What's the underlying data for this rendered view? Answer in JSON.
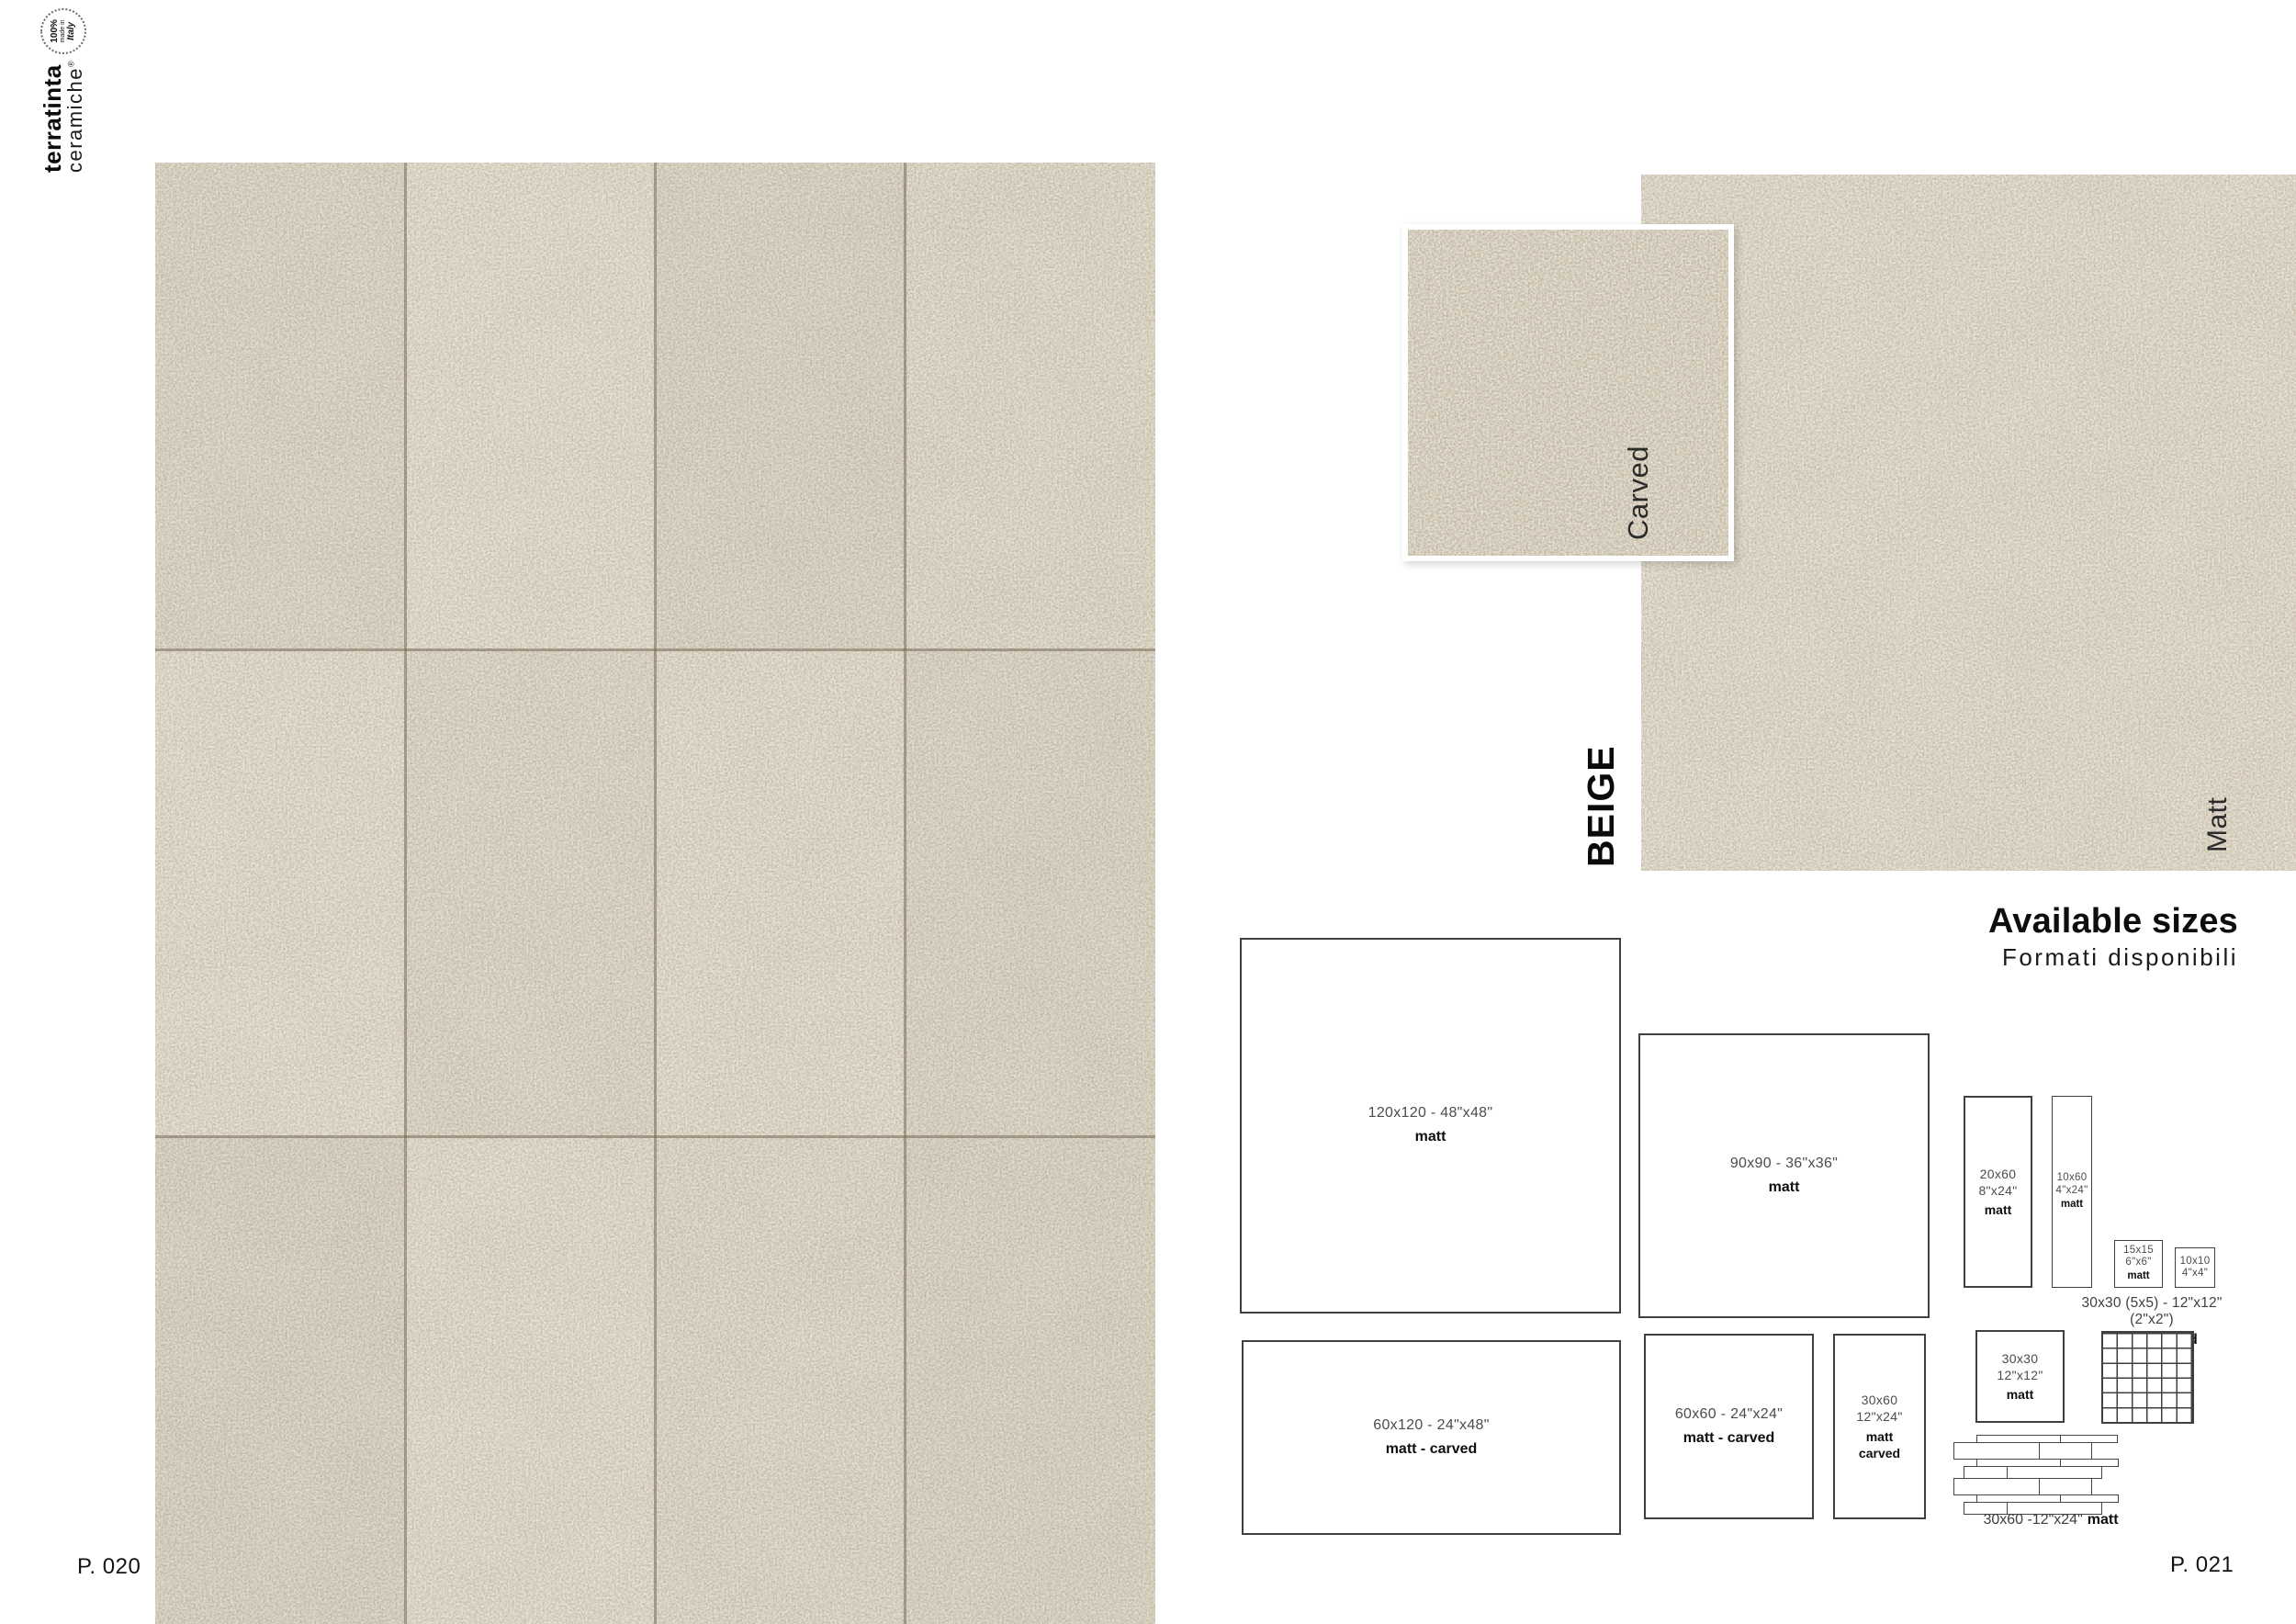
{
  "brand": {
    "name_bold": "terratinta",
    "name_light": "ceramiche",
    "reg": "®",
    "badge_percent": "100%",
    "badge_made": "made in",
    "badge_country": "Italy"
  },
  "pages": {
    "left": "P. 020",
    "right": "P. 021"
  },
  "product": {
    "collection": "BEIGE",
    "finishes": {
      "carved": "Carved",
      "matt": "Matt"
    }
  },
  "available_sizes": {
    "title": "Available sizes",
    "subtitle": "Formati disponibili",
    "boxes": {
      "s120x120": {
        "label": "120x120 - 48\"x48\"",
        "finish": "matt"
      },
      "s90x90": {
        "label": "90x90 - 36\"x36\"",
        "finish": "matt"
      },
      "s20x60": {
        "lines": [
          "20x60",
          "8\"x24\""
        ],
        "finish": "matt"
      },
      "s10x60": {
        "lines": [
          "10x60",
          "4\"x24\""
        ],
        "finish": "matt"
      },
      "s15x15": {
        "lines": [
          "15x15",
          "6\"x6\""
        ],
        "finish": "matt"
      },
      "s10x10": {
        "lines": [
          "10x10",
          "4\"x4\""
        ]
      },
      "s30x30": {
        "lines": [
          "30x30",
          "12\"x12\""
        ],
        "finish": "matt"
      },
      "s60x120": {
        "label": "60x120 - 24\"x48\"",
        "finish": "matt - carved"
      },
      "s60x60": {
        "label": "60x60 - 24\"x24\"",
        "finish": "matt - carved"
      },
      "s30x60": {
        "lines": [
          "30x60",
          "12\"x24\""
        ],
        "finish_lines": [
          "matt",
          "carved"
        ]
      }
    },
    "mosaic_caption": {
      "label": "30x30 (5x5) - 12\"x12\"(2\"x2\")",
      "finish": "matt - carved"
    },
    "muretto_caption": {
      "label": "30x60 -12\"x24\"",
      "finish": "matt"
    }
  },
  "colors": {
    "tile_beige": "#d4c9b4",
    "carved_beige": "#cfc3ad",
    "grout": "#766a56",
    "box_border": "#3f3f3f"
  }
}
